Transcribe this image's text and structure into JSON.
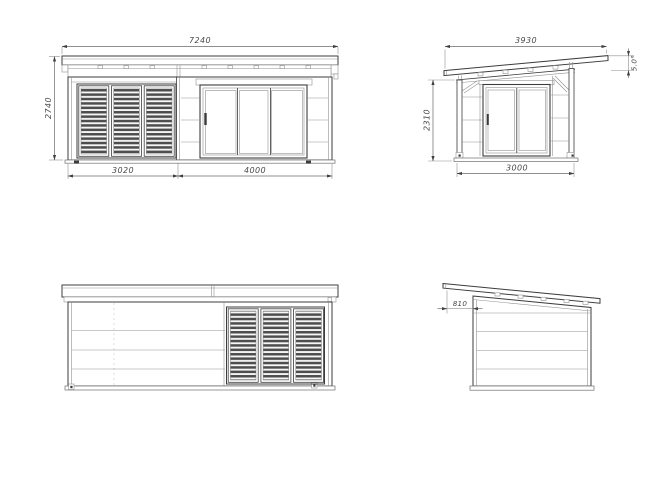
{
  "colors": {
    "background": "#ffffff",
    "outline": "#3c3c3c",
    "detail_line": "#919191",
    "dimension_line": "#6a6a6a",
    "dimension_text": "#4a4a4a",
    "louver_slat": "#4d4d4d"
  },
  "views": {
    "front_elevation": {
      "dims": {
        "total_width": "7240",
        "total_height": "2740",
        "left_section_width": "3020",
        "right_section_width": "4000"
      }
    },
    "side_elevation_right": {
      "dims": {
        "roof_length": "3930",
        "wall_height": "2310",
        "depth": "3000",
        "roof_pitch": "5.0°"
      }
    },
    "rear_elevation": {
      "dims": {}
    },
    "side_elevation_left": {
      "dims": {
        "roof_overhang": "810"
      }
    }
  }
}
